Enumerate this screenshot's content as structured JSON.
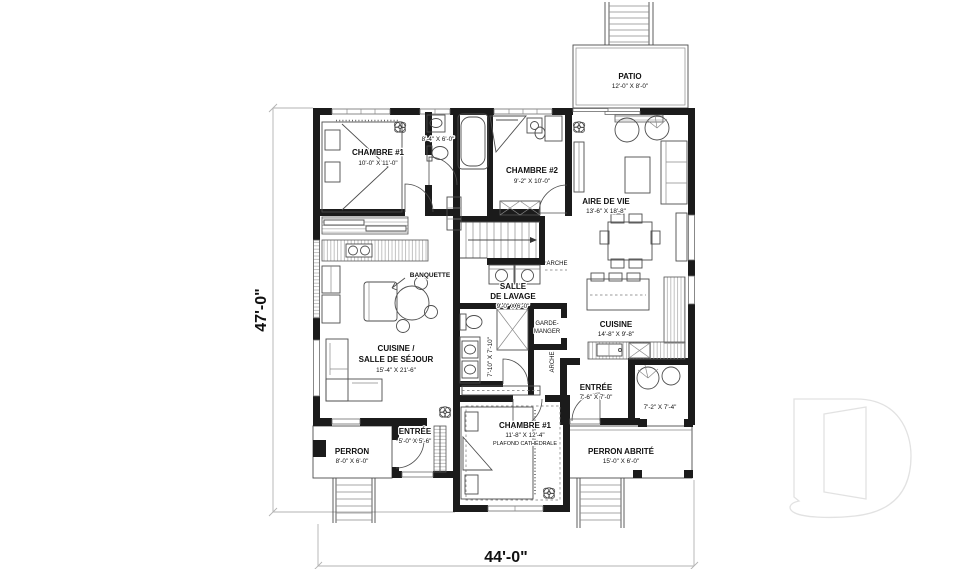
{
  "plan": {
    "overall_dimensions": {
      "height": "47'-0\"",
      "width": "44'-0\""
    },
    "rooms": {
      "chambre1_upper": {
        "name": "CHAMBRE #1",
        "dims": "10'-0\" X 11'-0\""
      },
      "bain_gauche": {
        "dims": "8'-4\" X 6'-0\""
      },
      "chambre2": {
        "name": "CHAMBRE #2",
        "dims": "9'-2\" X 10'-0\""
      },
      "aire_de_vie": {
        "name": "AIRE DE VIE",
        "dims": "13'-6\" X 18'-8\""
      },
      "salle_de_lavage": {
        "name1": "SALLE",
        "name2": "DE LAVAGE",
        "dims": "9'-0\" X 6'-0\""
      },
      "cuisine_droite": {
        "name": "CUISINE",
        "dims": "14'-8\" X 9'-8\""
      },
      "bain_droit": {
        "dims": "7'-10\" X 7'-10\""
      },
      "garde_manger": {
        "name1": "GARDE-",
        "name2": "MANGER"
      },
      "entree_droite": {
        "name": "ENTRÉE",
        "dims": "7'-6\" X 7'-0\""
      },
      "vestiaire": {
        "dims": "7'-2\" X 7'-4\""
      },
      "cuisine_sejour": {
        "name1": "CUISINE /",
        "name2": "SALLE DE SÉJOUR",
        "dims": "15'-4\" X 21'-6\""
      },
      "entree_gauche": {
        "name": "ENTRÉE",
        "dims": "5'-0\" X 5'-6\""
      },
      "perron": {
        "name": "PERRON",
        "dims": "8'-0\" X 6'-0\""
      },
      "chambre1_lower": {
        "name": "CHAMBRE #1",
        "dims": "11'-8\" X 12'-4\"",
        "note": "PLAFOND CATHÉDRALE"
      },
      "perron_abrite": {
        "name": "PERRON ABRITÉ",
        "dims": "15'-0\" X 6'-0\""
      },
      "patio": {
        "name": "PATIO",
        "dims": "12'-0\" X 8'-0\""
      }
    },
    "annotations": {
      "banquette": "BANQUETTE",
      "arche_escalier": "ARCHE",
      "arche_cuisine": "ARCHE"
    },
    "colors": {
      "walls": "#1b1b1b",
      "thin_lines": "#4d4d4d",
      "dim_lines": "#b3b3b3",
      "watermark": "#e2e2e2"
    }
  }
}
